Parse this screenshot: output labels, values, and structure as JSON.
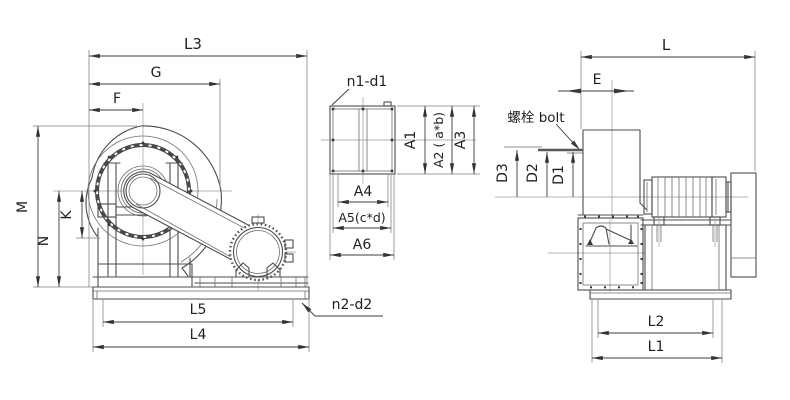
{
  "colors": {
    "line": "#4d4d4d",
    "text": "#1f1f1f",
    "background": "#ffffff"
  },
  "side_view": {
    "dim_l3": "L3",
    "dim_g": "G",
    "dim_f": "F",
    "dim_m": "M",
    "dim_k": "K",
    "dim_n": "N",
    "dim_l5": "L5",
    "dim_l4": "L4",
    "callout_base_holes": "n2-d2"
  },
  "outlet_flange_view": {
    "callout_holes": "n1-d1",
    "dim_a1": "A1",
    "dim_a2": "A2 ( a*b)",
    "dim_a3": "A3",
    "dim_a4": "A4",
    "dim_a5": "A5(c*d)",
    "dim_a6": "A6"
  },
  "end_view": {
    "callout_bolt": "螺栓 bolt",
    "dim_l": "L",
    "dim_e": "E",
    "dim_d3": "D3",
    "dim_d2": "D2",
    "dim_d1": "D1",
    "dim_l2": "L2",
    "dim_l1": "L1"
  }
}
